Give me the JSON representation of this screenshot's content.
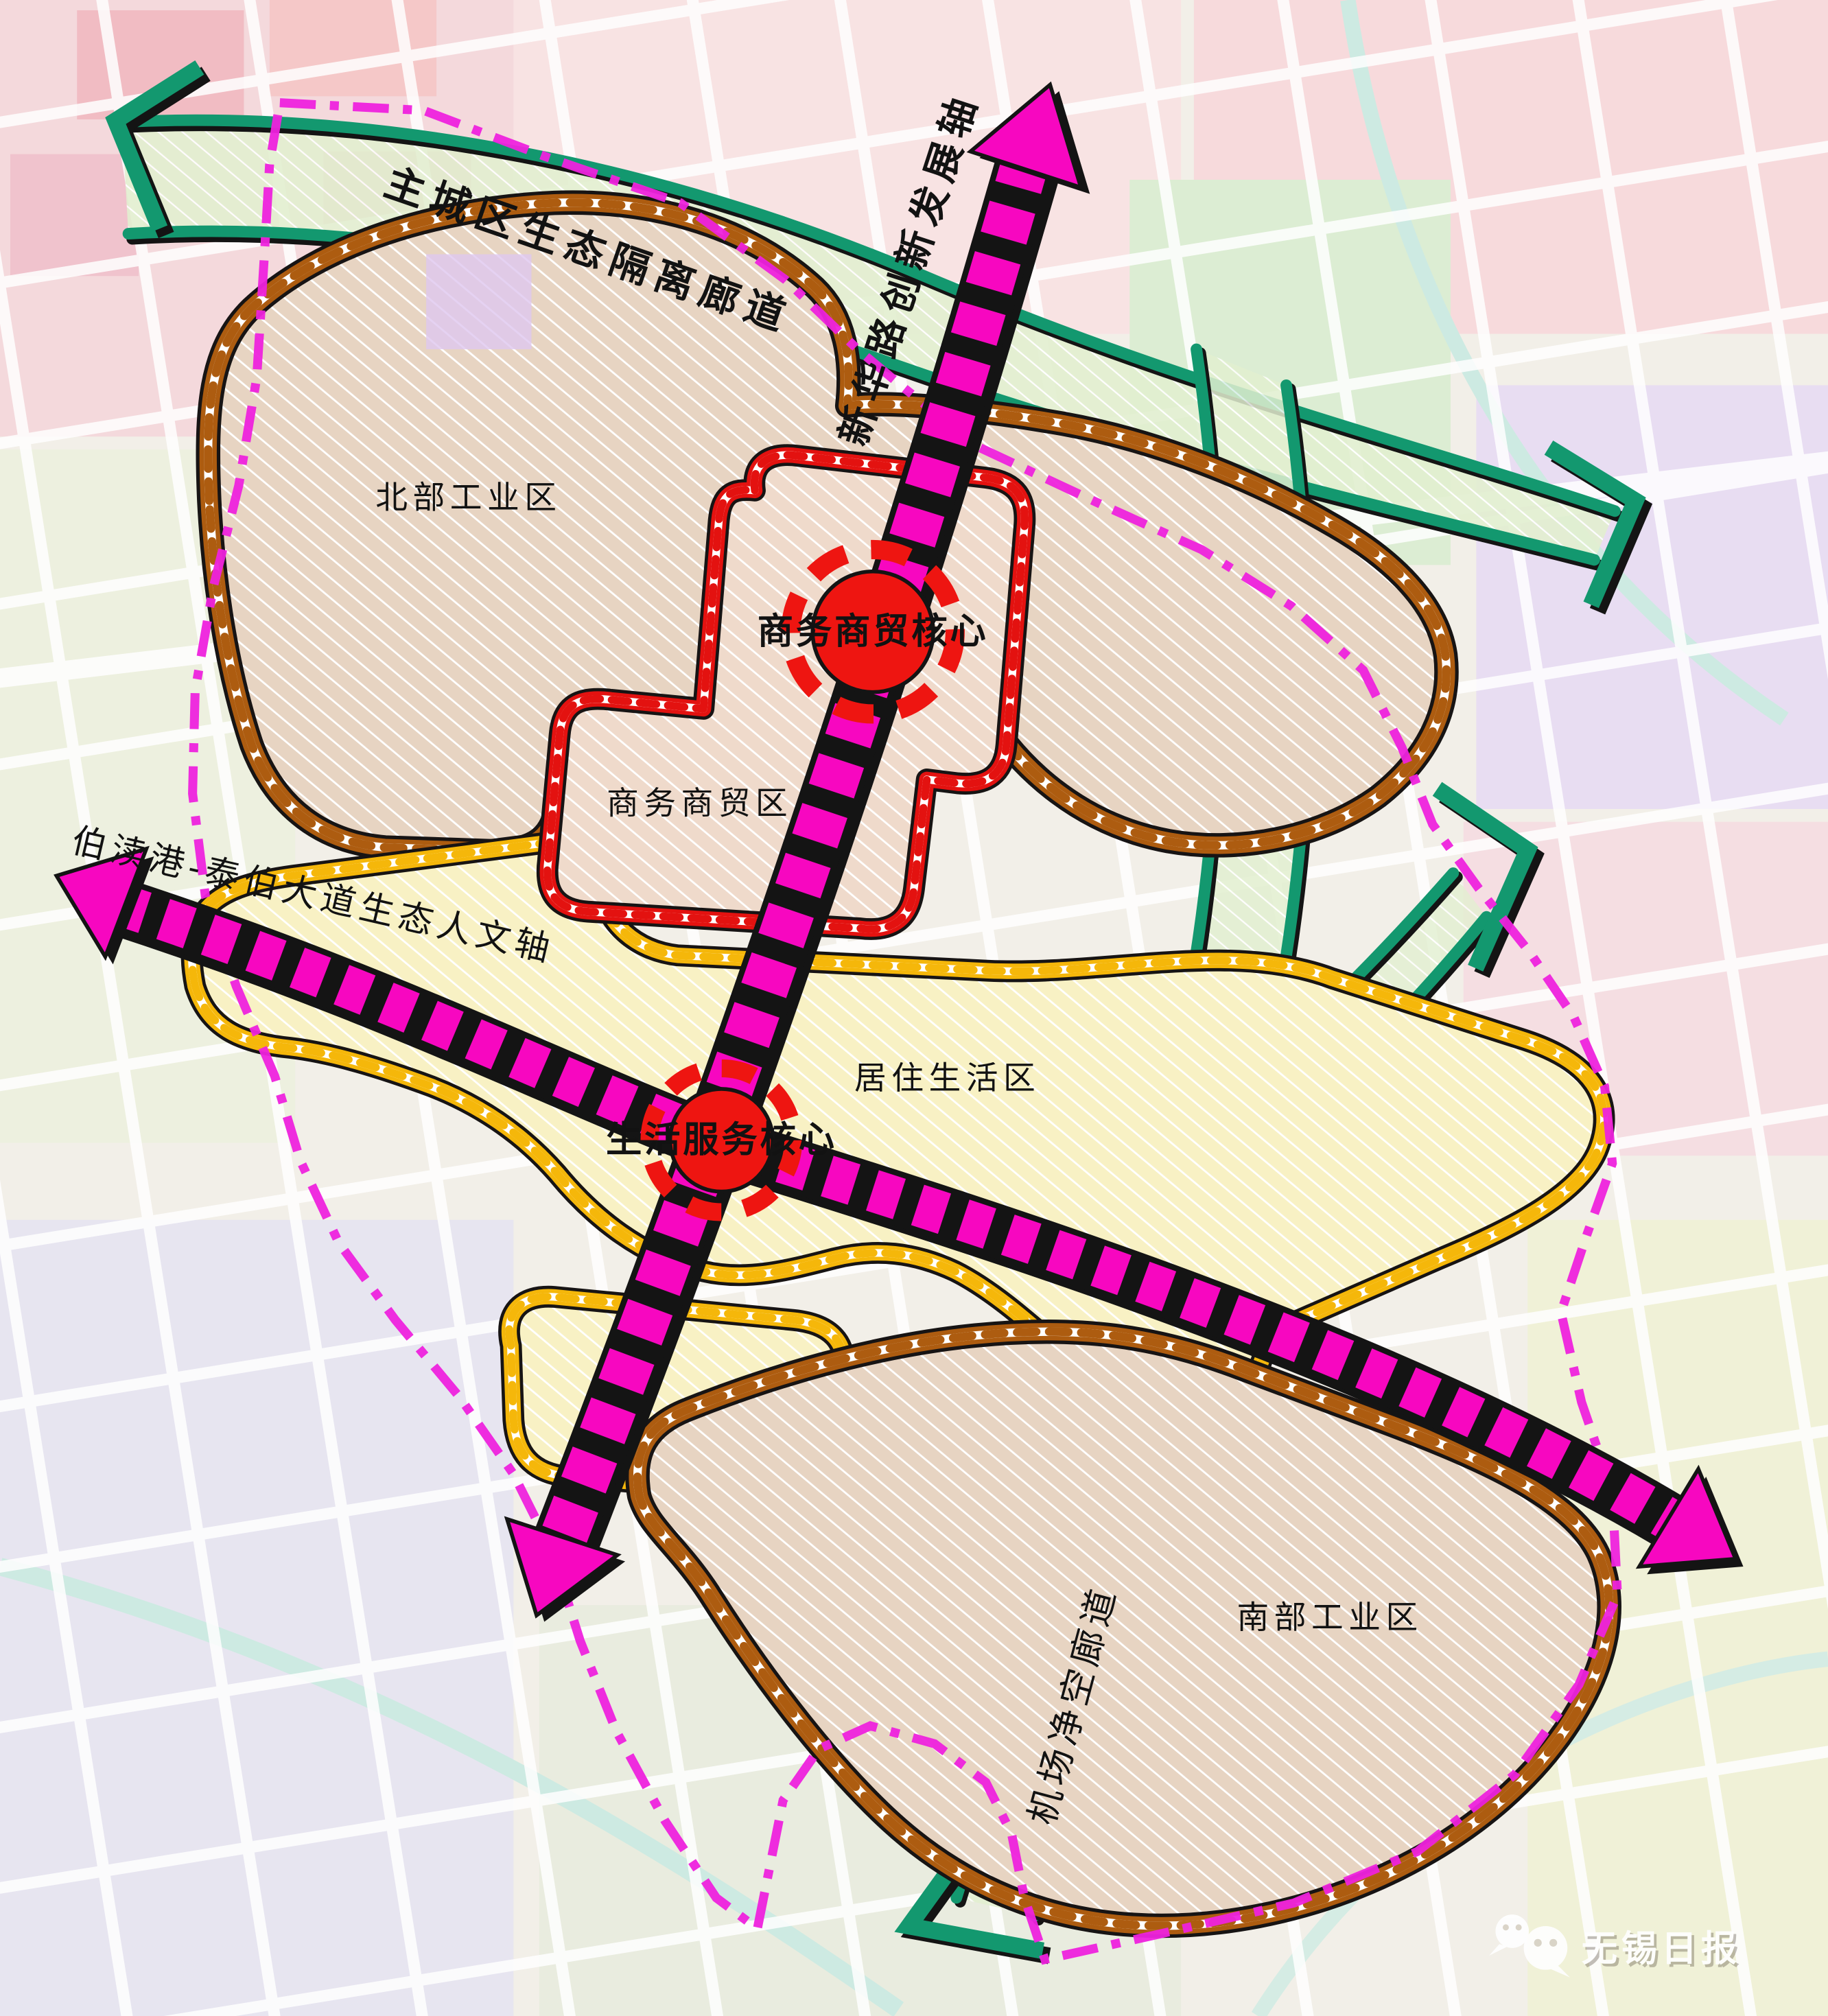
{
  "map": {
    "corridors": {
      "top": "主城区生态隔离廊道",
      "airport": "机场净空廊道"
    },
    "axes": {
      "innovation": "新华路创新发展轴",
      "humanities": "伯渎港-泰伯大道生态人文轴"
    },
    "cores": {
      "business": "商务商贸核心",
      "life": "生活服务核心"
    },
    "zones": {
      "north": "北部工业区",
      "business": "商务商贸区",
      "residential": "居住生活区",
      "south": "南部工业区"
    },
    "watermark": "无锡日报"
  },
  "colors": {
    "teal": "#13986f",
    "magenta": "#f707c0",
    "brown": "#ad5c10",
    "red": "#e31210",
    "yellow": "#f5b70a",
    "pboundary": "#ee22dd",
    "core_red": "#ee1511"
  }
}
